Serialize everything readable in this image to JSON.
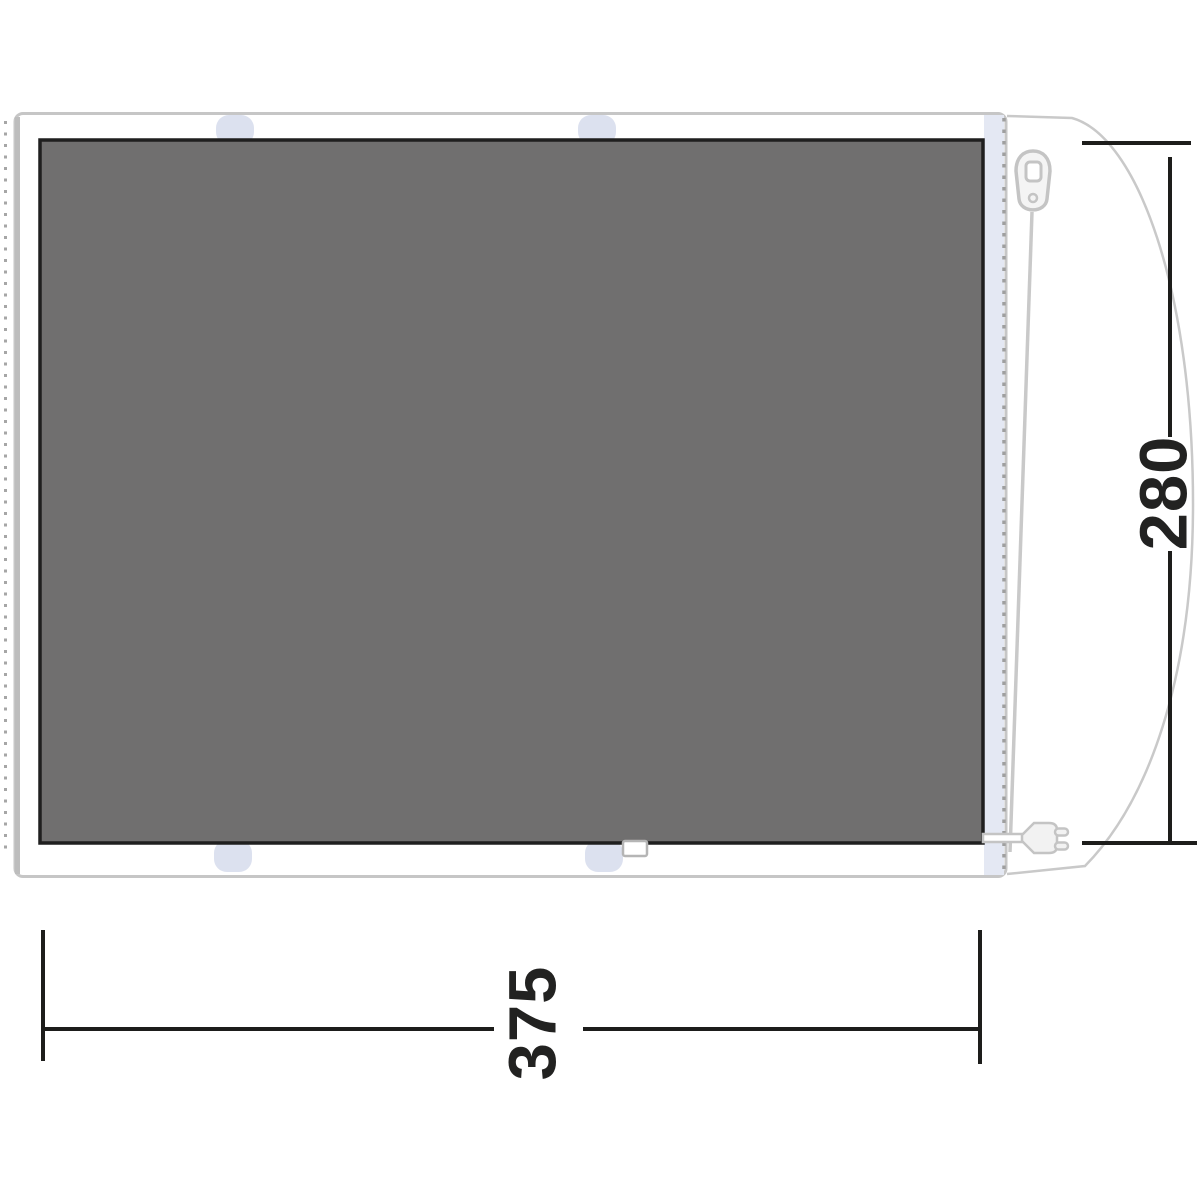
{
  "labels": {
    "height_dimension": "280",
    "width_dimension": "375"
  },
  "icons": {
    "zipper": "zipper-pull-icon",
    "plug": "power-plug-icon"
  },
  "colors": {
    "groundsheet_panel_fill": "#706f6f",
    "groundsheet_panel_border": "#1f1f1f",
    "outline_gray": "#c6c6c6",
    "attachment_tab": "#dce1ef",
    "zip_strip": "#e4e8f3",
    "stitch_dots": "#a6a6a6",
    "dimension_line": "#1d1d1b"
  }
}
